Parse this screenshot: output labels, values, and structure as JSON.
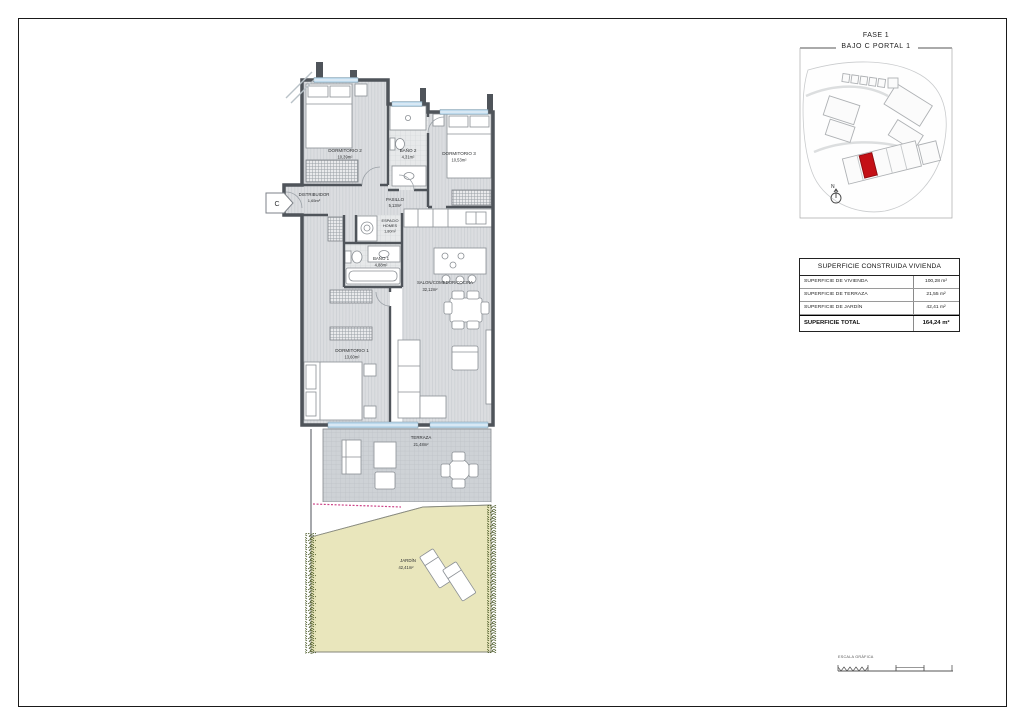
{
  "title_block": {
    "phase": "FASE 1",
    "unit": "BAJO C  PORTAL 1"
  },
  "plan": {
    "north_label": "N",
    "entrance_letter": "C",
    "rooms": {
      "dorm2": {
        "name": "DORMITORIO 2",
        "area": "10,39m²"
      },
      "bano2": {
        "name": "BAÑO 2",
        "area": "4,31m²"
      },
      "dorm3": {
        "name": "DORMITORIO 3",
        "area": "10,53m²"
      },
      "distribuidor": {
        "name": "DISTRIBUIDOR",
        "area": "1,65m²"
      },
      "pasillo": {
        "name": "PASILLO",
        "area": "5,13m²"
      },
      "espacio": {
        "name_l1": "ESPACIO",
        "name_l2": "HOMES",
        "area": "1,80m²"
      },
      "bano1": {
        "name": "BAÑO 1",
        "area": "4,88m²"
      },
      "salon": {
        "name": "SALON/COMEDOR/COCINA",
        "area": "32,12m²"
      },
      "dorm1": {
        "name": "DORMITORIO 1",
        "area": "13,60m²"
      },
      "terraza": {
        "name": "TERRAZA",
        "area": "21,48m²"
      },
      "jardin": {
        "name": "JARDÍN",
        "area": "42,41m²"
      }
    }
  },
  "table": {
    "header": "SUPERFICIE CONSTRUIDA VIVIENDA",
    "rows": [
      {
        "label": "SUPERFICIE DE VIVIENDA",
        "value": "100,28 m²"
      },
      {
        "label": "SUPERFICIE DE TERRAZA",
        "value": "21,55 m²"
      },
      {
        "label": "SUPERFICIE DE JARDÍN",
        "value": "42,41 m²"
      }
    ],
    "total": {
      "label": "SUPERFICIE TOTAL",
      "value": "164,24 m²"
    }
  },
  "scale": {
    "label": "ESCALA GRÁFICA"
  },
  "colors": {
    "wall": "#4f545a",
    "window": "#bcd9ec",
    "floor": "#dbdde0",
    "terrace": "#ced2d6",
    "garden": "#e9e6bc",
    "unit_marker_red": "#c41016",
    "vegetation": "#44541f"
  }
}
